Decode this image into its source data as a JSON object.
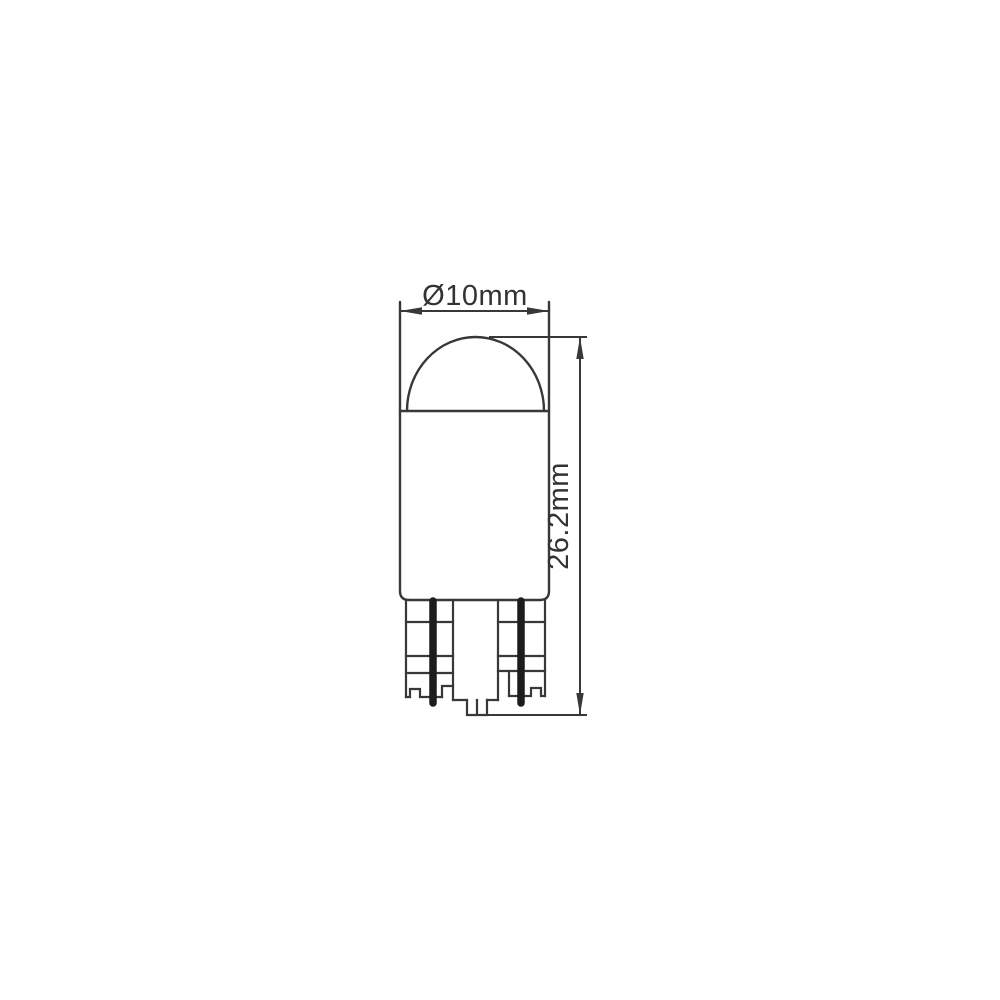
{
  "diagram": {
    "subject": "wedge-base-bulb-dimension-drawing",
    "view": "side-elevation",
    "labels": {
      "diameter": "Ø10mm",
      "height": "26.2mm"
    },
    "colors": {
      "line": "#383838",
      "wire": "#1c1c1c",
      "background": "#ffffff"
    }
  }
}
